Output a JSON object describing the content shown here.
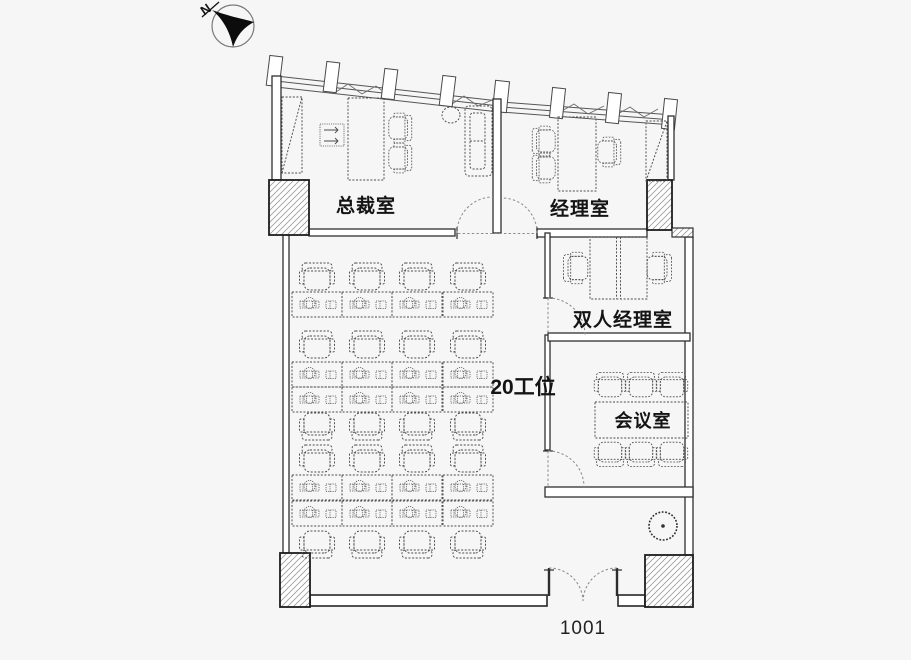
{
  "floor_plan": {
    "north_label": "N",
    "rooms": [
      {
        "id": "president-office",
        "label": "总裁室"
      },
      {
        "id": "manager-office",
        "label": "经理室"
      },
      {
        "id": "double-manager-office",
        "label": "双人经理室"
      },
      {
        "id": "meeting-room",
        "label": "会议室",
        "seat_count": 6
      }
    ],
    "open_area": {
      "label": "20工位",
      "workstation_count": 20
    },
    "entrance": {
      "label": "1001",
      "door_type": "double-swing"
    },
    "icons": {
      "north_arrow": "north-arrow-icon",
      "plant": "plant-icon"
    },
    "colors": {
      "background": "#f6f6f6",
      "line": "#303030",
      "hatch": "#9a9a9a"
    }
  }
}
